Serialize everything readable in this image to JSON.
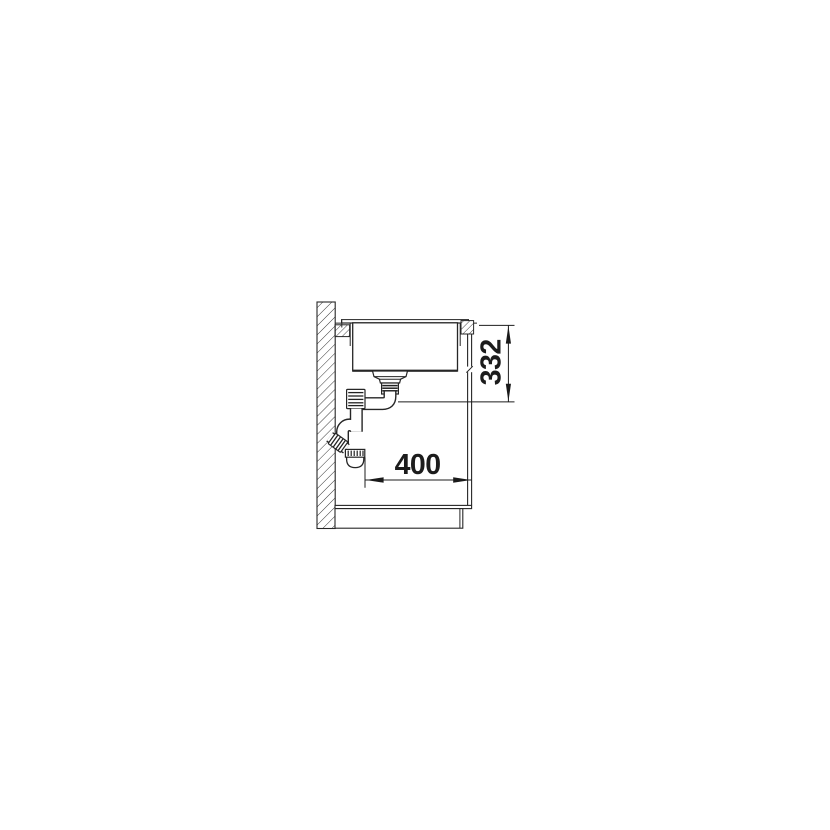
{
  "drawing": {
    "background": "#ffffff",
    "line_color": "#262626",
    "dimensions": {
      "vertical": {
        "value": "332"
      },
      "horizontal": {
        "value": "400"
      }
    }
  }
}
